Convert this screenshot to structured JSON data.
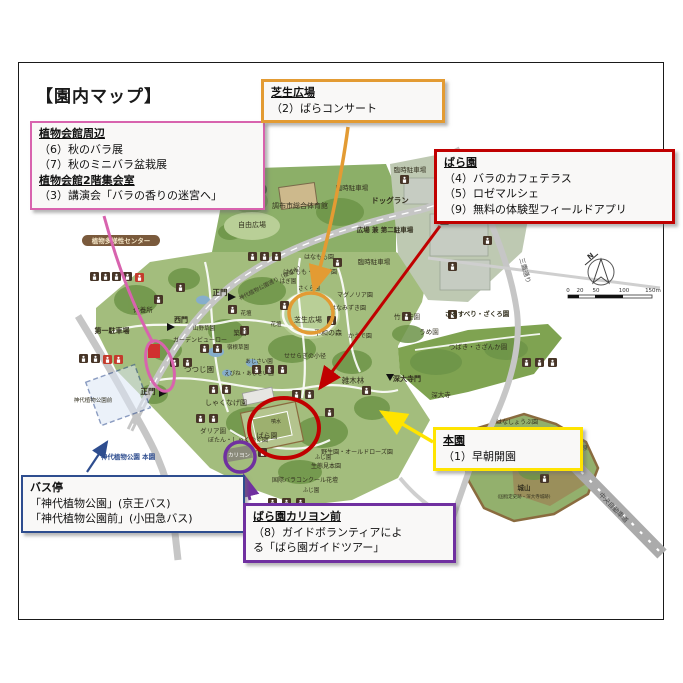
{
  "page": {
    "title": "【園内マップ】"
  },
  "colors": {
    "pink": "#d863ae",
    "orange": "#e39b33",
    "red": "#c00000",
    "yellow": "#ffe400",
    "blue": "#2e4d8f",
    "purple": "#7030a0"
  },
  "callouts": {
    "kaikan": {
      "title1": "植物会館周辺",
      "line1": "（6）秋のバラ展",
      "line2": "（7）秋のミニバラ盆栽展",
      "title2": "植物会館2階集会室",
      "line3": "（3）講演会「バラの香りの迷宮へ」"
    },
    "shibafu": {
      "title": "芝生広場",
      "line1": "（2）ばらコンサート"
    },
    "baraen": {
      "title": "ばら園",
      "line1": "（4）バラのカフェテラス",
      "line2": "（5）ロゼマルシェ",
      "line3": "（9）無料の体験型フィールドアプリ"
    },
    "honen": {
      "title": "本園",
      "line1": "（1）早朝開園"
    },
    "bus": {
      "title": "バス停",
      "line1": "「神代植物公園」(京王バス)",
      "line2": "「神代植物公園前」(小田急バス)"
    },
    "carillon": {
      "title": "ばら園カリヨン前",
      "line1": "（8）ガイドボランティアによ",
      "line2": "る「ばら園ガイドツアー」"
    }
  },
  "map": {
    "labels": [
      {
        "t": "調布市総合体育館",
        "x": 300,
        "y": 208,
        "s": 7
      },
      {
        "t": "自由広場",
        "x": 252,
        "y": 227,
        "s": 7
      },
      {
        "t": "臨時駐車場",
        "x": 352,
        "y": 190,
        "s": 6.5
      },
      {
        "t": "臨時駐車場",
        "x": 410,
        "y": 172,
        "s": 6.5
      },
      {
        "t": "ドッグラン",
        "x": 390,
        "y": 203,
        "s": 7.5,
        "b": 1
      },
      {
        "t": "広場 兼 第二駐車場",
        "x": 385,
        "y": 232,
        "s": 6.5,
        "b": 1
      },
      {
        "t": "臨時駐車場",
        "x": 374,
        "y": 264,
        "s": 6.5
      },
      {
        "t": "正門",
        "x": 220,
        "y": 295,
        "s": 7.5,
        "b": 1
      },
      {
        "t": "西門",
        "x": 181,
        "y": 322,
        "s": 7,
        "b": 1
      },
      {
        "t": "休養所",
        "x": 143,
        "y": 312,
        "s": 6.5
      },
      {
        "t": "第一駐車場",
        "x": 112,
        "y": 333,
        "s": 7,
        "b": 1
      },
      {
        "t": "山野草園",
        "x": 204,
        "y": 330,
        "s": 5.5
      },
      {
        "t": "築山",
        "x": 240,
        "y": 335,
        "s": 6.5
      },
      {
        "t": "ガーデンビューロー",
        "x": 200,
        "y": 342,
        "s": 6
      },
      {
        "t": "つつじ園",
        "x": 199,
        "y": 372,
        "s": 7.5
      },
      {
        "t": "正門",
        "x": 148,
        "y": 394,
        "s": 7.5,
        "b": 1
      },
      {
        "t": "しゃくなげ園",
        "x": 226,
        "y": 405,
        "s": 7
      },
      {
        "t": "ダリア園",
        "x": 213,
        "y": 433,
        "s": 6.5
      },
      {
        "t": "ぼたん・しゃくやく園",
        "x": 238,
        "y": 442,
        "s": 6
      },
      {
        "t": "はぎ園",
        "x": 288,
        "y": 283,
        "s": 5.5
      },
      {
        "t": "さくら園",
        "x": 309,
        "y": 290,
        "s": 5.5
      },
      {
        "t": "はなもも園",
        "x": 319,
        "y": 259,
        "s": 6
      },
      {
        "t": "はなもも・むくげ園",
        "x": 310,
        "y": 274,
        "s": 6
      },
      {
        "t": "マグノリア園",
        "x": 355,
        "y": 297,
        "s": 6
      },
      {
        "t": "はなみずき園",
        "x": 348,
        "y": 310,
        "s": 6
      },
      {
        "t": "花壇",
        "x": 246,
        "y": 315,
        "s": 5.5
      },
      {
        "t": "花壇",
        "x": 276,
        "y": 326,
        "s": 5.5
      },
      {
        "t": "芝生広場",
        "x": 308,
        "y": 322,
        "s": 7
      },
      {
        "t": "平和の森",
        "x": 328,
        "y": 335,
        "s": 7
      },
      {
        "t": "かえで園",
        "x": 360,
        "y": 338,
        "s": 6
      },
      {
        "t": "せせらぎの小径",
        "x": 305,
        "y": 358,
        "s": 6
      },
      {
        "t": "宿根草園",
        "x": 238,
        "y": 349,
        "s": 5.5
      },
      {
        "t": "あじさい園",
        "x": 259,
        "y": 363,
        "s": 5.5
      },
      {
        "t": "えびね・あじさい園",
        "x": 249,
        "y": 375,
        "s": 5.5
      },
      {
        "t": "雑木林",
        "x": 353,
        "y": 383,
        "s": 7.5
      },
      {
        "t": "深大寺門",
        "x": 407,
        "y": 381,
        "s": 7,
        "b": 1
      },
      {
        "t": "深大寺",
        "x": 441,
        "y": 397,
        "s": 6.5
      },
      {
        "t": "ばら園",
        "x": 267,
        "y": 438,
        "s": 7
      },
      {
        "t": "噴水",
        "x": 276,
        "y": 423,
        "s": 5
      },
      {
        "t": "カリヨン",
        "x": 239,
        "y": 457,
        "s": 5.5,
        "c": "#ffffff"
      },
      {
        "t": "野生園・オールドローズ園",
        "x": 357,
        "y": 454,
        "s": 6
      },
      {
        "t": "生態見本園",
        "x": 326,
        "y": 468,
        "s": 6
      },
      {
        "t": "国際バラコンクール花壇",
        "x": 305,
        "y": 482,
        "s": 6
      },
      {
        "t": "ふじ園",
        "x": 323,
        "y": 459,
        "s": 5.5
      },
      {
        "t": "ふじ園",
        "x": 311,
        "y": 492,
        "s": 5.5
      },
      {
        "t": "竹・笹園",
        "x": 407,
        "y": 319,
        "s": 6.5
      },
      {
        "t": "さるすべり・ざくろ園",
        "x": 477,
        "y": 316,
        "s": 6.5,
        "b": 1
      },
      {
        "t": "うめ園",
        "x": 429,
        "y": 334,
        "s": 6.5
      },
      {
        "t": "つばき・さざんか園",
        "x": 478,
        "y": 349,
        "s": 6.5
      },
      {
        "t": "はなしょうぶ園",
        "x": 517,
        "y": 424,
        "s": 6
      },
      {
        "t": "田んぼ",
        "x": 573,
        "y": 438,
        "s": 6
      },
      {
        "t": "アシ原",
        "x": 579,
        "y": 450,
        "s": 6
      },
      {
        "t": "城山",
        "x": 524,
        "y": 490,
        "s": 6.5,
        "b": 1
      },
      {
        "t": "(国指定史跡・深大寺城跡)",
        "x": 524,
        "y": 498,
        "s": 4.5
      },
      {
        "t": "神代植物公園前",
        "x": 93,
        "y": 402,
        "s": 5.5
      },
      {
        "t": "神代植物公園 本園",
        "x": 128,
        "y": 459,
        "s": 6.5,
        "b": 1,
        "c": "#2e4d8f"
      },
      {
        "t": "中央自動車道",
        "x": 612,
        "y": 509,
        "s": 6.5,
        "r": 46,
        "c": "#4a4a4a"
      },
      {
        "t": "三鷹通り",
        "x": 523,
        "y": 271,
        "s": 6.5,
        "r": 74,
        "c": "#4a4a4a"
      },
      {
        "t": "神代植物公園通り（桜並木）",
        "x": 272,
        "y": 284,
        "s": 5.5,
        "r": -27,
        "c": "#3d3b2a"
      },
      {
        "t": "植物多様性センター",
        "x": 121,
        "y": 243,
        "s": 6.5,
        "b": 1,
        "c": "#f5e7c8"
      },
      {
        "t": "区域",
        "x": 252,
        "y": 192,
        "s": 6,
        "b": 1,
        "c": "#ffffff"
      },
      {
        "t": "N",
        "x": 592,
        "y": 258,
        "s": 7,
        "b": 1,
        "r": -38,
        "c": "#333333"
      },
      {
        "t": "0",
        "x": 568,
        "y": 292,
        "s": 5.5,
        "c": "#333333"
      },
      {
        "t": "20",
        "x": 580,
        "y": 292,
        "s": 5.5,
        "c": "#333333"
      },
      {
        "t": "50",
        "x": 596,
        "y": 292,
        "s": 5.5,
        "c": "#333333"
      },
      {
        "t": "100",
        "x": 624,
        "y": 292,
        "s": 5.5,
        "c": "#333333"
      },
      {
        "t": "150m",
        "x": 653,
        "y": 292,
        "s": 5.5,
        "c": "#333333"
      }
    ],
    "icons": [
      {
        "x": 90,
        "y": 272
      },
      {
        "x": 101,
        "y": 272
      },
      {
        "x": 112,
        "y": 272
      },
      {
        "x": 123,
        "y": 272
      },
      {
        "x": 135,
        "y": 273,
        "v": "r"
      },
      {
        "x": 176,
        "y": 283
      },
      {
        "x": 248,
        "y": 252
      },
      {
        "x": 260,
        "y": 252
      },
      {
        "x": 272,
        "y": 252
      },
      {
        "x": 333,
        "y": 258
      },
      {
        "x": 400,
        "y": 175
      },
      {
        "x": 456,
        "y": 166
      },
      {
        "x": 440,
        "y": 216
      },
      {
        "x": 448,
        "y": 262
      },
      {
        "x": 483,
        "y": 236
      },
      {
        "x": 228,
        "y": 305
      },
      {
        "x": 280,
        "y": 301
      },
      {
        "x": 327,
        "y": 316
      },
      {
        "x": 200,
        "y": 344
      },
      {
        "x": 213,
        "y": 344
      },
      {
        "x": 240,
        "y": 326
      },
      {
        "x": 170,
        "y": 358
      },
      {
        "x": 183,
        "y": 358
      },
      {
        "x": 79,
        "y": 354
      },
      {
        "x": 91,
        "y": 354
      },
      {
        "x": 103,
        "y": 355,
        "v": "r"
      },
      {
        "x": 114,
        "y": 355,
        "v": "r"
      },
      {
        "x": 252,
        "y": 365
      },
      {
        "x": 265,
        "y": 365
      },
      {
        "x": 278,
        "y": 365
      },
      {
        "x": 209,
        "y": 385
      },
      {
        "x": 222,
        "y": 385
      },
      {
        "x": 196,
        "y": 414
      },
      {
        "x": 209,
        "y": 414
      },
      {
        "x": 292,
        "y": 390
      },
      {
        "x": 305,
        "y": 390
      },
      {
        "x": 325,
        "y": 408
      },
      {
        "x": 258,
        "y": 448
      },
      {
        "x": 268,
        "y": 498
      },
      {
        "x": 282,
        "y": 498
      },
      {
        "x": 296,
        "y": 498
      },
      {
        "x": 402,
        "y": 312
      },
      {
        "x": 448,
        "y": 310
      },
      {
        "x": 522,
        "y": 358
      },
      {
        "x": 535,
        "y": 358
      },
      {
        "x": 548,
        "y": 358
      },
      {
        "x": 540,
        "y": 474
      },
      {
        "x": 154,
        "y": 295
      },
      {
        "x": 362,
        "y": 386
      }
    ]
  }
}
